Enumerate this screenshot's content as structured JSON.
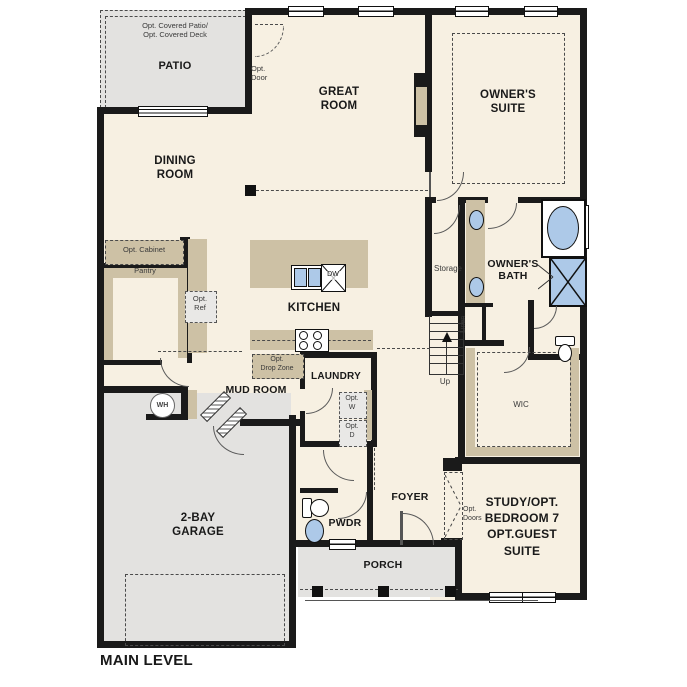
{
  "title": "MAIN LEVEL",
  "rooms": {
    "patio": {
      "note": "Opt. Covered Patio/\nOpt. Covered Deck",
      "label": "PATIO"
    },
    "great_room": {
      "label": "GREAT\nROOM"
    },
    "owners_suite": {
      "label": "OWNER'S\nSUITE"
    },
    "dining_room": {
      "label": "DINING\nROOM"
    },
    "kitchen": {
      "label": "KITCHEN"
    },
    "storage": {
      "label": "Storage"
    },
    "owners_bath": {
      "label": "OWNER'S\nBATH"
    },
    "linen": {
      "label": "Linen"
    },
    "wic": {
      "label": "WIC"
    },
    "mud_room": {
      "label": "MUD ROOM"
    },
    "laundry": {
      "label": "LAUNDRY"
    },
    "garage": {
      "label": "2-BAY\nGARAGE"
    },
    "pwdr": {
      "label": "PWDR"
    },
    "foyer": {
      "label": "FOYER"
    },
    "porch": {
      "label": "PORCH"
    },
    "study": {
      "label": "STUDY/OPT.\nBEDROOM 7\nOPT.GUEST\nSUITE"
    }
  },
  "annotations": {
    "opt_door": "Opt.\nDoor",
    "opt_cabinet": "Opt. Cabinet",
    "pantry": "Pantry",
    "opt_ref": "Opt.\nRef",
    "opt_drop_zone": "Opt.\nDrop Zone",
    "opt_washer": "Opt.\nW",
    "opt_dryer": "Opt.\nD",
    "opt_doors": "Opt.\nDoors",
    "up": "Up",
    "water_heater": "WH",
    "dishwasher": "DW"
  },
  "colors": {
    "floor": "#f7f0e2",
    "outdoor_gray": "#e3e2e0",
    "cabinet_tan": "#cdc1a5",
    "fixture_blue": "#adc9e8",
    "wall": "#1a1a1a"
  }
}
